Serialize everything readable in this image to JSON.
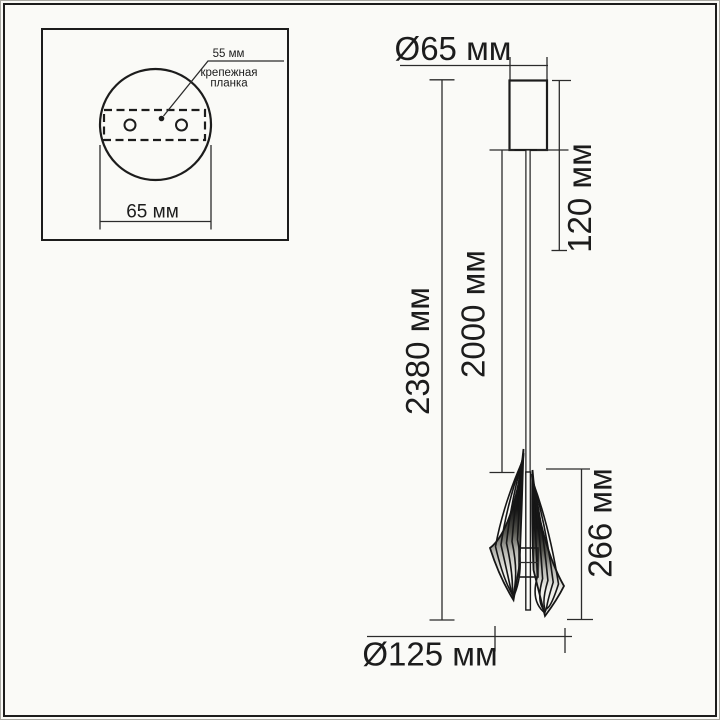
{
  "colors": {
    "paper": "#fafaf7",
    "ink": "#1c1c1c"
  },
  "inset": {
    "plate_span_label": "55 мм",
    "plate_name_line1": "крепежная",
    "plate_name_line2": "планка",
    "base_diameter_label": "65 мм"
  },
  "drawing": {
    "canopy_diameter_label": "Ø65 мм",
    "canopy_drop_label": "120 мм",
    "total_height_label": "2380 мм",
    "cable_length_label": "2000 мм",
    "shade_height_label": "266 мм",
    "shade_diameter_label": "Ø125 мм"
  }
}
